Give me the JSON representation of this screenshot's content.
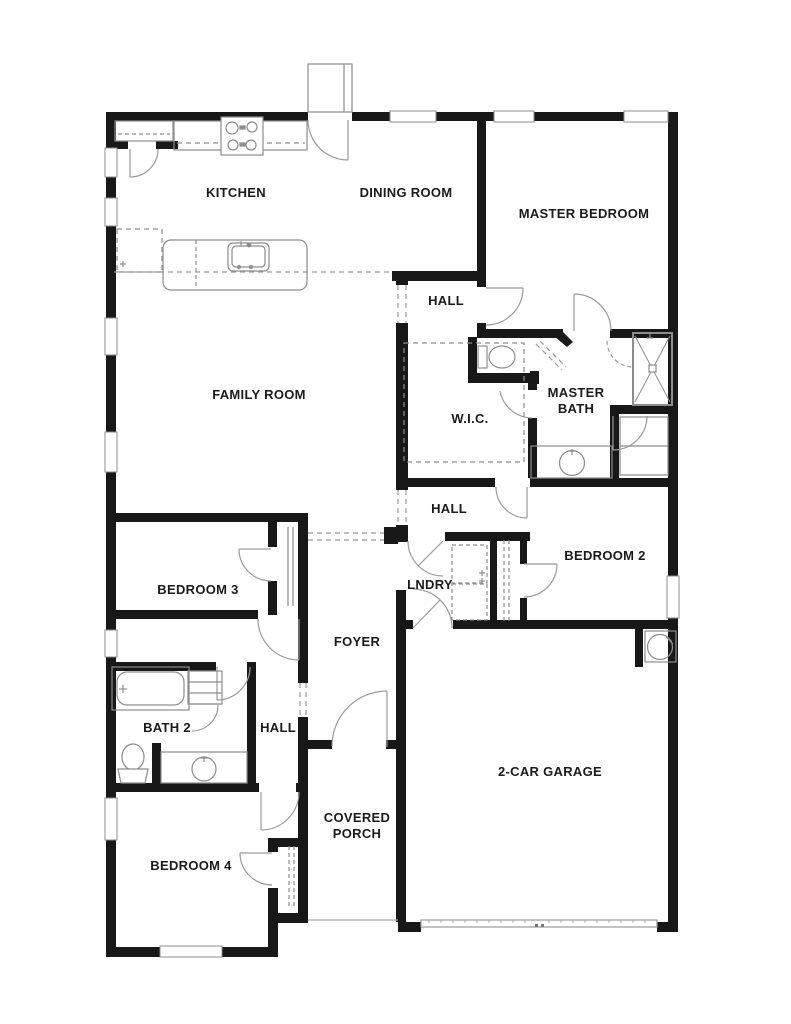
{
  "title": "Floor plan",
  "rooms": {
    "kitchen": "KITCHEN",
    "dining_room": "DINING ROOM",
    "master_bedroom": "MASTER BEDROOM",
    "hall_upper": "HALL",
    "family_room": "FAMILY ROOM",
    "wic": "W.I.C.",
    "master_bath": "MASTER BATH",
    "hall_mid": "HALL",
    "bedroom_2": "BEDROOM 2",
    "bedroom_3": "BEDROOM 3",
    "laundry": "LNDRY",
    "foyer": "FOYER",
    "bath_2": "BATH 2",
    "hall_lower": "HALL",
    "garage": "2-CAR GARAGE",
    "covered_porch": "COVERED PORCH",
    "bedroom_4": "BEDROOM 4"
  },
  "fixtures": [
    "stove",
    "kitchen-island-sink",
    "refrigerator",
    "pantry-shelf",
    "toilet",
    "shower",
    "bathtub",
    "vanity-sink",
    "linen-shelves",
    "washer-dryer",
    "water-heater",
    "garage-door",
    "front-stoop"
  ],
  "colors": {
    "wall": "#181818",
    "background": "#ffffff",
    "fixture_line": "#8d8d8d",
    "door_arc": "#9a9a9a",
    "label_text": "#1b1b1b"
  }
}
